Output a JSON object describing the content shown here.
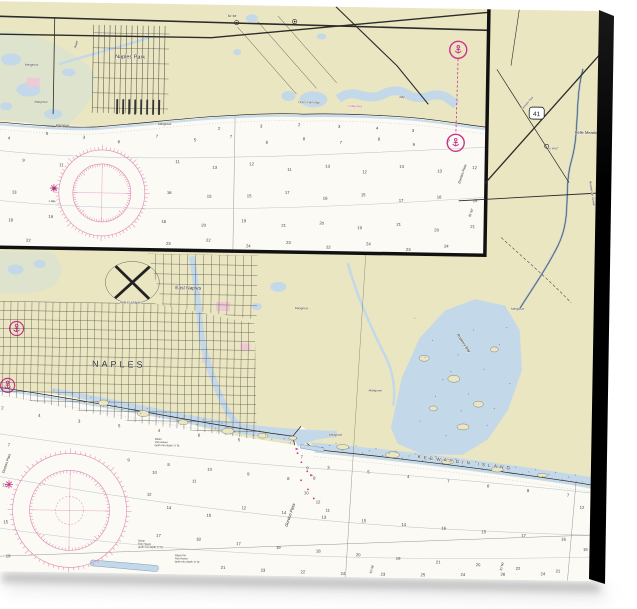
{
  "product": {
    "background_color": "#ffffff",
    "canvas_edge_color": "#0c0c0c"
  },
  "chart": {
    "colors": {
      "land": "#ebe6c2",
      "water": "#c3d8e8",
      "marsh": "#dde3cd",
      "urban_pink": "#eec9d6",
      "magenta": "#c9348c",
      "rose": "#df86b4",
      "contour": "#b5c3cd",
      "ink": "#2b2b2b",
      "sea": "#fbfaf4"
    },
    "shield": {
      "label": "41"
    },
    "labels": [
      {
        "id": "label-naples-park",
        "text": "Naples Park",
        "x": 131,
        "y": 55,
        "size": 5.5,
        "a": "middle"
      },
      {
        "id": "label-river",
        "text": "River",
        "x": 77,
        "y": 46,
        "size": 3.4,
        "rot": -78,
        "italic": true
      },
      {
        "id": "label-mangrove-1",
        "text": "Mangrove",
        "x": 26,
        "y": 64,
        "size": 3,
        "italic": true
      },
      {
        "id": "label-mangrove-2",
        "text": "Mangrove",
        "x": 36,
        "y": 101,
        "size": 3,
        "italic": true
      },
      {
        "id": "label-mangrove-3",
        "text": "Mangrove",
        "x": 58,
        "y": 124,
        "size": 3,
        "italic": true
      },
      {
        "id": "label-mangrove-4",
        "text": "Mangrove",
        "x": 160,
        "y": 121,
        "size": 3,
        "italic": true
      },
      {
        "id": "label-outer-clam-bay",
        "text": "Outer Clam Bay",
        "x": 300,
        "y": 97,
        "size": 3,
        "italic": true
      },
      {
        "id": "label-bay",
        "text": "Bay",
        "x": 401,
        "y": 90,
        "size": 3,
        "italic": true
      },
      {
        "id": "label-cable-area",
        "text": "Cable Area",
        "x": 350,
        "y": 100,
        "size": 2.8,
        "color": "#c9348c"
      },
      {
        "id": "label-lon-81-48-inset",
        "text": "81°48'",
        "x": 228,
        "y": 12,
        "size": 3.2
      },
      {
        "id": "label-one-mile",
        "text": "1 Mile",
        "x": 52,
        "y": 200,
        "size": 2.6
      },
      {
        "id": "label-doctors-pass-inset",
        "text": "Doctors Pass",
        "x": 463,
        "y": 175,
        "size": 3.4,
        "rot": -72,
        "italic": true
      },
      {
        "id": "label-lon-81-50-inset",
        "text": "81°50'",
        "x": 474,
        "y": 208,
        "size": 3,
        "rot": -72
      },
      {
        "id": "label-belle-meade",
        "text": "Belle Meade",
        "x": 577,
        "y": 123,
        "size": 4
      },
      {
        "id": "label-tamiami-trail",
        "text": "Tamiami Trail",
        "x": 524,
        "y": 100,
        "size": 2.8,
        "rot": -49
      },
      {
        "id": "label-to-mast",
        "text": "TO MAST",
        "x": 550,
        "y": 139,
        "size": 2.5
      },
      {
        "id": "label-henderson-creek",
        "text": "Henderson Creek",
        "x": 592,
        "y": 170,
        "size": 3.2,
        "rot": 80,
        "italic": true
      },
      {
        "id": "label-east-naples",
        "text": "East Naples",
        "x": 180,
        "y": 285,
        "size": 4.8
      },
      {
        "id": "label-naples",
        "text": "NAPLES",
        "x": 98,
        "y": 364,
        "size": 9,
        "ls": 3
      },
      {
        "id": "label-naples-airport",
        "text": "NAPLES AIRPORT",
        "x": 136,
        "y": 300,
        "size": 2.5,
        "a": "middle"
      },
      {
        "id": "label-gordon-pass",
        "text": "Gordon Pass",
        "x": 296,
        "y": 521,
        "size": 4.2,
        "rot": -72,
        "italic": true
      },
      {
        "id": "label-keewaydin-island",
        "text": "KEEWAYDIN  ISLAND",
        "x": 425,
        "y": 450,
        "size": 4.6,
        "rot": 6,
        "ls": 3.2
      },
      {
        "id": "label-rookery-bay",
        "text": "Rookery Bay",
        "x": 462,
        "y": 326,
        "size": 3.8,
        "rot": 55,
        "italic": true
      },
      {
        "id": "label-doctors-pass-main",
        "text": "Doctors Pass",
        "x": 12,
        "y": 472,
        "size": 3.4,
        "rot": -72,
        "italic": true
      },
      {
        "id": "label-mangrove-5",
        "text": "Mangrove",
        "x": 300,
        "y": 303,
        "size": 3,
        "italic": true
      },
      {
        "id": "label-mangrove-6",
        "text": "Mangrove",
        "x": 516,
        "y": 300,
        "size": 3,
        "italic": true
      },
      {
        "id": "label-mangrove-7",
        "text": "Mangrove",
        "x": 375,
        "y": 384,
        "size": 3,
        "italic": true
      },
      {
        "id": "label-mangrove-8",
        "text": "Mangrove",
        "x": 336,
        "y": 429,
        "size": 3,
        "italic": true
      },
      {
        "id": "label-lon-81-48-main",
        "text": "81°48'",
        "x": 381,
        "y": 566,
        "size": 3,
        "rot": -75
      },
      {
        "id": "label-lon-81-50-main",
        "text": "81°50'",
        "x": 511,
        "y": 561,
        "size": 3,
        "rot": -75
      },
      {
        "id": "label-lon-81-46-main",
        "text": "81°46'",
        "x": 5,
        "y": 549,
        "size": 3,
        "rot": -75
      }
    ],
    "notes": [
      {
        "x": 147,
        "y": 538,
        "size": 2.6,
        "lines": [
          "Obstn",
          "Fish Haven",
          "(auth min depth 17 ft)"
        ]
      },
      {
        "x": 184,
        "y": 552,
        "size": 2.6,
        "lines": [
          "Obstn PA",
          "Fish Haven",
          "(auth min depth 17 ft)"
        ]
      },
      {
        "x": 162,
        "y": 436,
        "size": 2.6,
        "lines": [
          "Obstn",
          "Fish Haven",
          "(auth min depth 17 ft)"
        ]
      }
    ],
    "compass_roses": [
      {
        "cx": 105,
        "cy": 190,
        "r1": 43,
        "r2": 29,
        "r3": 0
      },
      {
        "cx": 78,
        "cy": 508,
        "r1": 57,
        "r2": 40,
        "r3": 14
      }
    ],
    "soundings": [
      [
        10,
        138,
        "4"
      ],
      [
        48,
        133,
        "5"
      ],
      [
        85,
        136,
        "3"
      ],
      [
        120,
        140,
        "6"
      ],
      [
        158,
        134,
        "7"
      ],
      [
        196,
        137,
        "5"
      ],
      [
        232,
        133,
        "7"
      ],
      [
        268,
        138,
        "6"
      ],
      [
        305,
        134,
        "8"
      ],
      [
        342,
        137,
        "7"
      ],
      [
        380,
        133,
        "8"
      ],
      [
        415,
        138,
        "9"
      ],
      [
        450,
        134,
        "7"
      ],
      [
        220,
        125,
        "2"
      ],
      [
        262,
        122,
        "3"
      ],
      [
        300,
        120,
        "2"
      ],
      [
        340,
        121,
        "3"
      ],
      [
        378,
        122,
        "4"
      ],
      [
        414,
        124,
        "3"
      ],
      [
        25,
        160,
        "9"
      ],
      [
        62,
        164,
        "11"
      ],
      [
        178,
        159,
        "11"
      ],
      [
        215,
        164,
        "13"
      ],
      [
        252,
        160,
        "12"
      ],
      [
        290,
        165,
        "11"
      ],
      [
        328,
        161,
        "13"
      ],
      [
        365,
        166,
        "12"
      ],
      [
        402,
        160,
        "14"
      ],
      [
        440,
        164,
        "13"
      ],
      [
        475,
        160,
        "12"
      ],
      [
        15,
        192,
        "13"
      ],
      [
        55,
        188,
        "15"
      ],
      [
        170,
        190,
        "16"
      ],
      [
        210,
        193,
        "15"
      ],
      [
        250,
        192,
        "15"
      ],
      [
        288,
        188,
        "17"
      ],
      [
        326,
        193,
        "16"
      ],
      [
        364,
        189,
        "15"
      ],
      [
        402,
        194,
        "17"
      ],
      [
        440,
        190,
        "16"
      ],
      [
        476,
        193,
        "15"
      ],
      [
        12,
        220,
        "18"
      ],
      [
        52,
        216,
        "19"
      ],
      [
        165,
        219,
        "18"
      ],
      [
        205,
        222,
        "20"
      ],
      [
        245,
        217,
        "19"
      ],
      [
        285,
        221,
        "21"
      ],
      [
        323,
        218,
        "20"
      ],
      [
        361,
        222,
        "19"
      ],
      [
        400,
        218,
        "21"
      ],
      [
        438,
        223,
        "20"
      ],
      [
        474,
        219,
        "21"
      ],
      [
        30,
        240,
        "22"
      ],
      [
        170,
        241,
        "23"
      ],
      [
        210,
        237,
        "22"
      ],
      [
        250,
        242,
        "24"
      ],
      [
        290,
        238,
        "23"
      ],
      [
        330,
        242,
        "22"
      ],
      [
        370,
        238,
        "24"
      ],
      [
        410,
        243,
        "23"
      ],
      [
        448,
        239,
        "24"
      ],
      [
        8,
        408,
        "2"
      ],
      [
        45,
        415,
        "4"
      ],
      [
        85,
        420,
        "3"
      ],
      [
        125,
        424,
        "5"
      ],
      [
        165,
        428,
        "4"
      ],
      [
        205,
        432,
        "6"
      ],
      [
        245,
        436,
        "5"
      ],
      [
        335,
        462,
        "3"
      ],
      [
        375,
        466,
        "5"
      ],
      [
        415,
        470,
        "4"
      ],
      [
        455,
        474,
        "7"
      ],
      [
        495,
        478,
        "6"
      ],
      [
        535,
        482,
        "8"
      ],
      [
        575,
        486,
        "7"
      ],
      [
        15,
        445,
        "7"
      ],
      [
        135,
        458,
        "9"
      ],
      [
        175,
        462,
        "8"
      ],
      [
        215,
        466,
        "10"
      ],
      [
        255,
        470,
        "9"
      ],
      [
        295,
        474,
        "8"
      ],
      [
        308,
        452,
        "7"
      ],
      [
        314,
        463,
        "9"
      ],
      [
        321,
        473,
        "8"
      ],
      [
        312,
        488,
        "10"
      ],
      [
        324,
        497,
        "12"
      ],
      [
        334,
        505,
        "11"
      ],
      [
        160,
        470,
        "10"
      ],
      [
        200,
        478,
        "11"
      ],
      [
        155,
        492,
        "12"
      ],
      [
        175,
        505,
        "14"
      ],
      [
        215,
        512,
        "15"
      ],
      [
        10,
        485,
        "11"
      ],
      [
        250,
        504,
        "12"
      ],
      [
        290,
        508,
        "14"
      ],
      [
        330,
        512,
        "13"
      ],
      [
        370,
        515,
        "15"
      ],
      [
        410,
        518,
        "14"
      ],
      [
        450,
        521,
        "16"
      ],
      [
        490,
        524,
        "15"
      ],
      [
        530,
        527,
        "17"
      ],
      [
        570,
        530,
        "16"
      ],
      [
        12,
        522,
        "15"
      ],
      [
        165,
        533,
        "17"
      ],
      [
        205,
        536,
        "18"
      ],
      [
        245,
        540,
        "17"
      ],
      [
        285,
        543,
        "19"
      ],
      [
        325,
        546,
        "18"
      ],
      [
        365,
        549,
        "20"
      ],
      [
        405,
        552,
        "19"
      ],
      [
        445,
        555,
        "21"
      ],
      [
        485,
        557,
        "20"
      ],
      [
        525,
        560,
        "22"
      ],
      [
        565,
        562,
        "21"
      ],
      [
        15,
        556,
        "19"
      ],
      [
        230,
        564,
        "21"
      ],
      [
        270,
        566,
        "23"
      ],
      [
        310,
        567,
        "22"
      ],
      [
        350,
        568,
        "24"
      ],
      [
        390,
        568,
        "23"
      ],
      [
        430,
        568,
        "25"
      ],
      [
        470,
        567,
        "24"
      ],
      [
        510,
        566,
        "26"
      ],
      [
        550,
        565,
        "24"
      ],
      [
        592,
        540,
        "19"
      ],
      [
        588,
        498,
        "12"
      ]
    ]
  }
}
